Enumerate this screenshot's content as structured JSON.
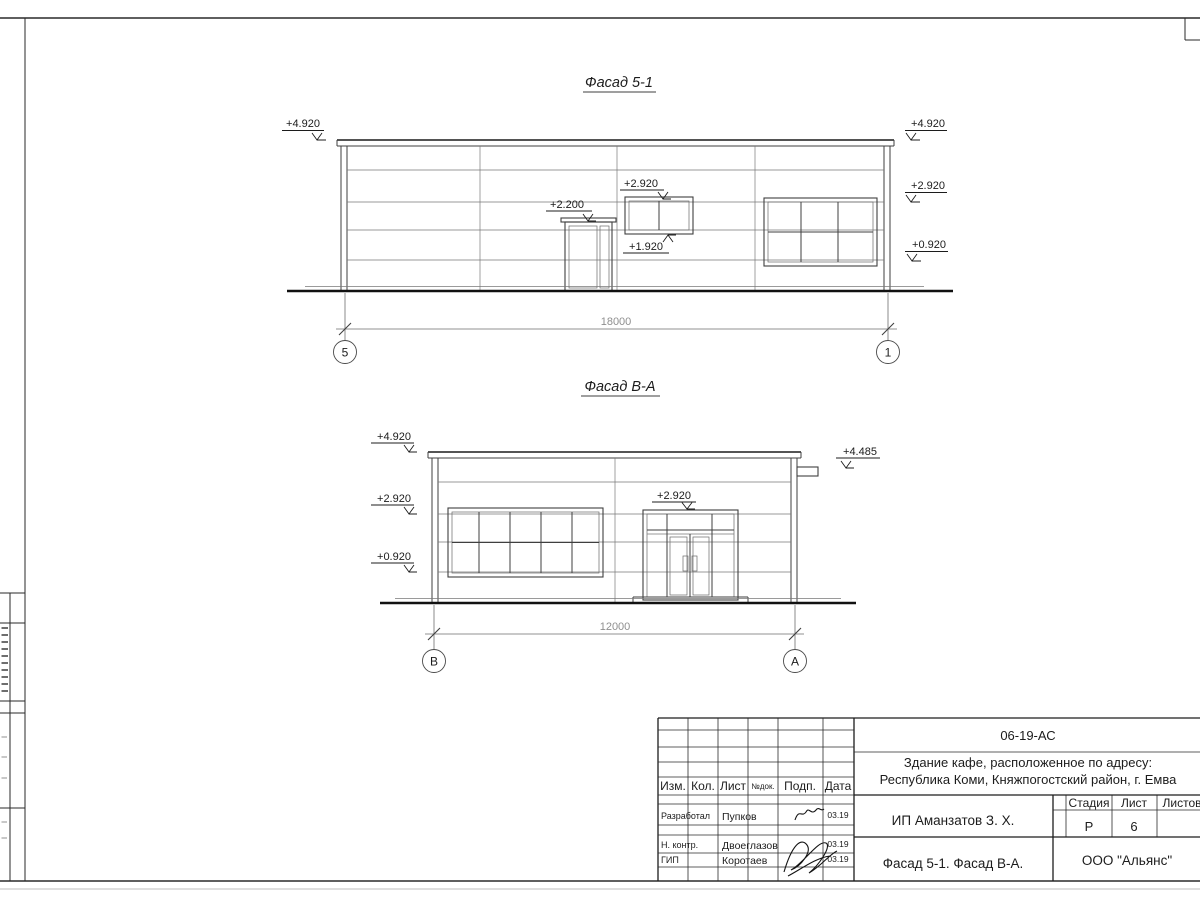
{
  "facade_51": {
    "title": "Фасад 5-1",
    "dim": "18000",
    "axis_left": "5",
    "axis_right": "1",
    "levels": {
      "parapet_left": "+4.920",
      "parapet_right": "+4.920",
      "mid_right": "+2.920",
      "sill_right": "+0.920",
      "door_top": "+2.200",
      "small_win_top": "+2.920",
      "small_win_sill": "+1.920"
    }
  },
  "facade_va": {
    "title": "Фасад В-А",
    "dim": "12000",
    "axis_left": "В",
    "axis_right": "А",
    "levels": {
      "parapet_left": "+4.920",
      "mid_left": "+2.920",
      "sill_left": "+0.920",
      "canopy_right": "+4.485",
      "door_top": "+2.920"
    }
  },
  "title_block": {
    "doc_code": "06-19-АС",
    "object_line1": "Здание кафе, расположенное по адресу:",
    "object_line2": "Республика Коми, Княжпогостский район, г. Емва",
    "columns": {
      "izm": "Изм.",
      "kol": "Кол.",
      "list": "Лист",
      "ndok": "№док.",
      "podp": "Подп.",
      "data": "Дата"
    },
    "rows": [
      {
        "role": "Разработал",
        "name": "Пупков",
        "date": "03.19"
      },
      {
        "role": "Н. контр.",
        "name": "Двоеглазов",
        "date": "03.19"
      },
      {
        "role": "ГИП",
        "name": "Коротаев",
        "date": "03.19"
      }
    ],
    "client": "ИП Аманзатов З. Х.",
    "stage_label": "Стадия",
    "sheet_label": "Лист",
    "sheets_label": "Листов",
    "stage_value": "Р",
    "sheet_value": "6",
    "drawing_title": "Фасад 5-1. Фасад В-А.",
    "organization": "ООО \"Альянс\""
  }
}
